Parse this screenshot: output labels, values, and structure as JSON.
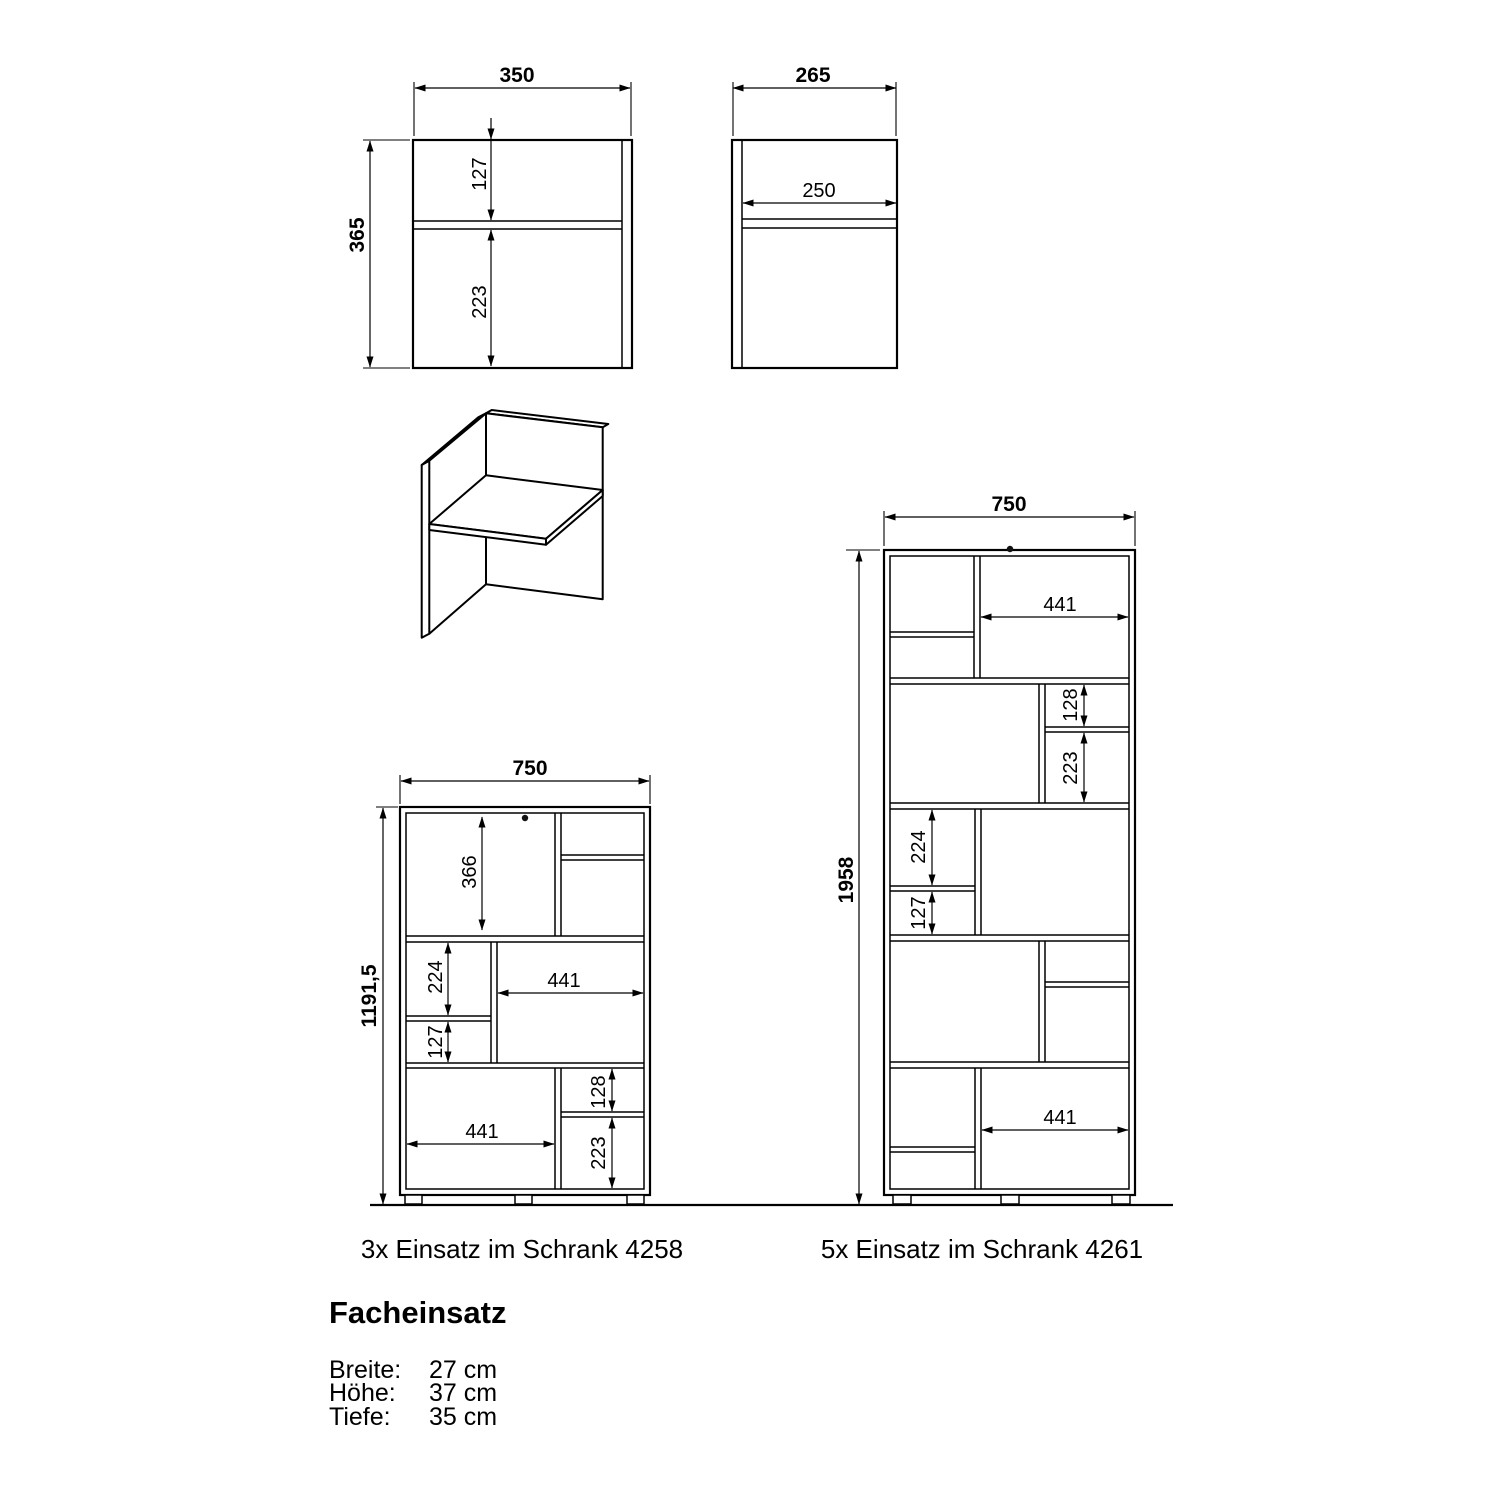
{
  "front_view": {
    "width": "350",
    "height": "365",
    "top_section": "127",
    "bottom_section": "223"
  },
  "side_view": {
    "width": "265",
    "shelf_depth": "250"
  },
  "cabinet_4258": {
    "caption": "3x Einsatz im Schrank 4258",
    "width": "750",
    "height": "1191,5",
    "top_cell": "366",
    "mid_upper": "224",
    "mid_lower": "127",
    "mid_width": "441",
    "bottom_width": "441",
    "bottom_upper": "128",
    "bottom_lower": "223"
  },
  "cabinet_4261": {
    "caption": "5x Einsatz im Schrank 4261",
    "width": "750",
    "height": "1958",
    "row1_width": "441",
    "row2_upper": "128",
    "row2_lower": "223",
    "row3_upper": "224",
    "row3_lower": "127",
    "row5_width": "441"
  },
  "footer": {
    "title": "Facheinsatz",
    "specs": [
      {
        "label": "Breite:",
        "value": "27 cm"
      },
      {
        "label": "Höhe:",
        "value": "37 cm"
      },
      {
        "label": "Tiefe:",
        "value": "35 cm"
      }
    ]
  }
}
